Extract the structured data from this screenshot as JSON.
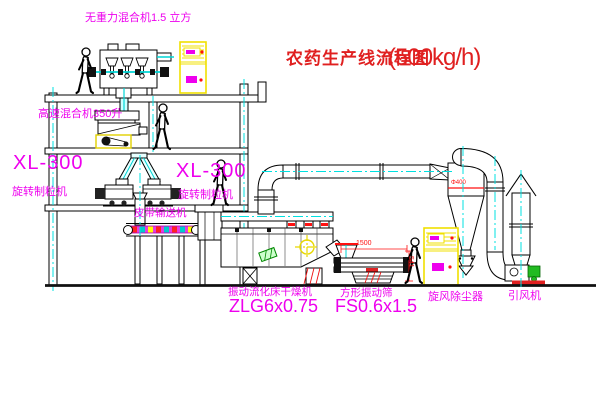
{
  "title": {
    "name": "农药生产线流程图",
    "capacity": "(500kg/h)"
  },
  "labels": {
    "gravity_mixer": "无重力混合机1.5 立方",
    "high_speed_mixer": "高速混合机350升",
    "granulator_left": {
      "model": "XL-300",
      "name": "旋转制粒机"
    },
    "granulator_right": {
      "model": "XL-300",
      "name": "旋转制粒机"
    },
    "belt_conveyor": "皮带输送机",
    "fluid_bed_dryer": {
      "name": "振动流化床干燥机",
      "model": "ZLG6x0.75"
    },
    "vibrating_sieve": {
      "name": "方形振动筛",
      "model": "FS0.6x1.5"
    },
    "cyclone": "旋风除尘器",
    "induced_draft_fan": "引风机"
  },
  "dimensions": {
    "sieve_length": "1500",
    "sieve_height": "541",
    "cyclone_diameter": "Φ400"
  },
  "colors": {
    "label_magenta": "#ee00ee",
    "title_red": "#e02020",
    "dimension_red": "#ff1111",
    "centerline_cyan": "#00e0e0",
    "cabinet_yellow": "#f0e000",
    "line_black": "#000000"
  }
}
